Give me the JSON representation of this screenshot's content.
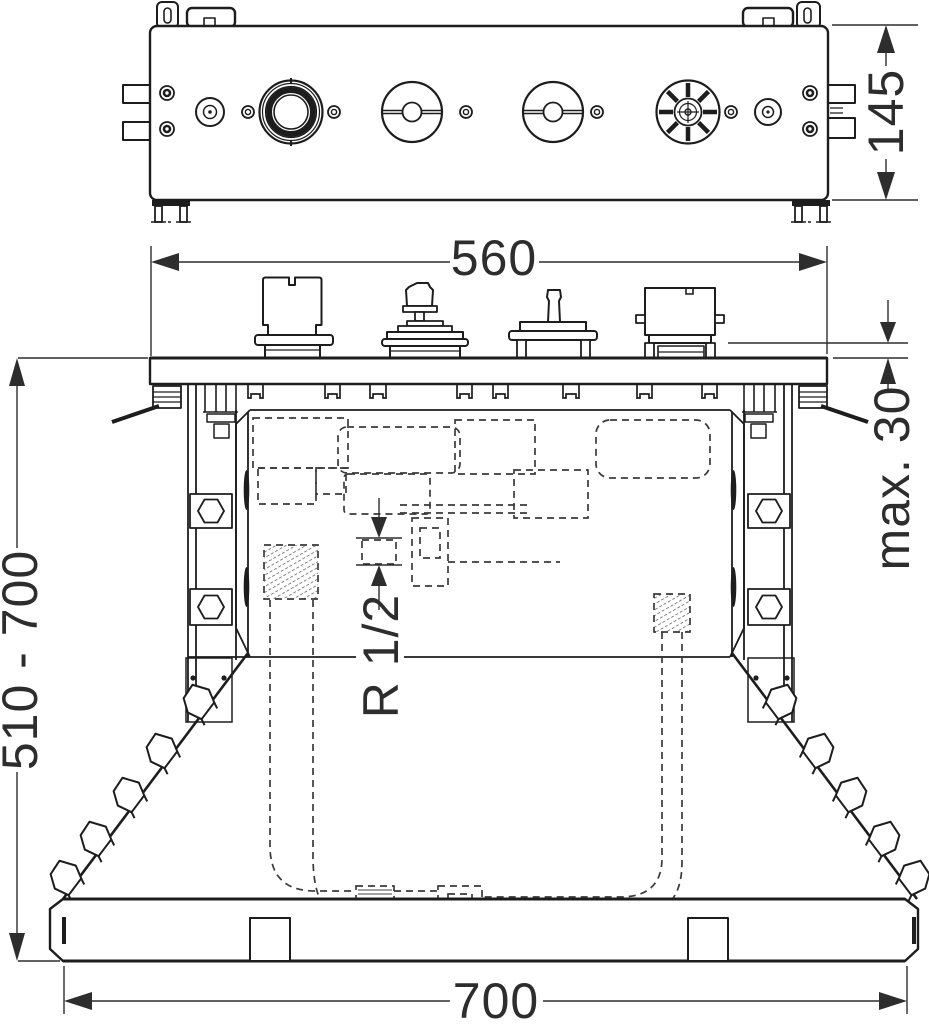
{
  "colors": {
    "line": "#1d1d1d",
    "dim": "#2d2d2d",
    "background": "#ffffff"
  },
  "dims": {
    "front_height": "145",
    "body_width": "560",
    "tile_max": "max. 30",
    "install_height": "510 - 700",
    "base_width": "700",
    "pipe_thread": "R 1/2"
  }
}
